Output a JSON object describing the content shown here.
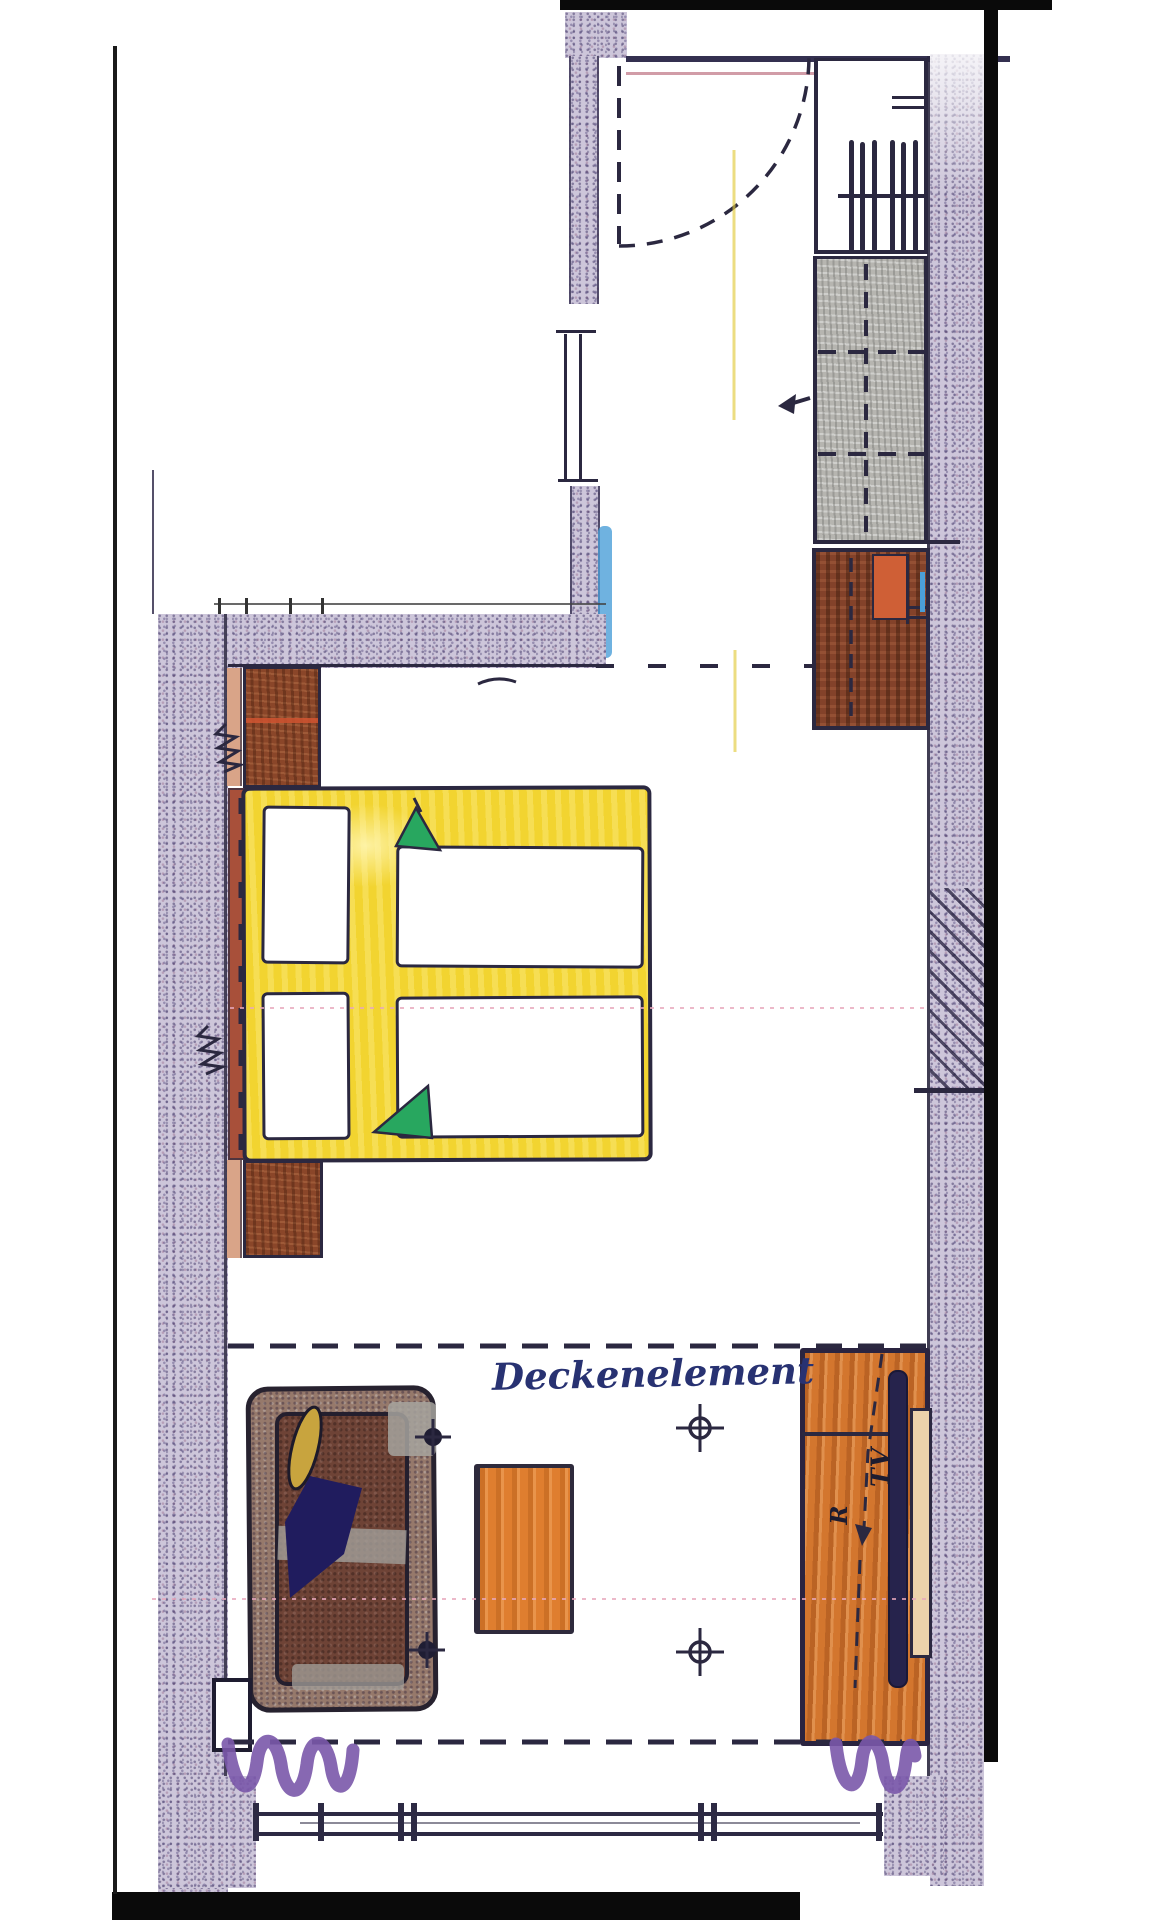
{
  "labels": {
    "ceiling_element": "Deckenelement",
    "tv": "TV",
    "shelf": "R"
  },
  "palette": {
    "ink": "#2b2840",
    "wall_base": "#cdc6da",
    "gray_base": "#b6b5b0",
    "bed_yellow": "#f2d430",
    "accent_green": "#28a75f",
    "headboard_red": "#a8503a",
    "nightstand_brown": "#8a4629",
    "cabinet_brown": "#83422a",
    "cabinet_orange": "#cf5f36",
    "sideboard_orange": "#d3762e",
    "table_orange": "#df7e2f",
    "sofa_maroon": "#6e4336",
    "throw_blue": "#201c5e",
    "pillow_yellow": "#c8a43e",
    "curtain_purple": "#7a58aa",
    "glass_blue": "#4b9fd8",
    "scan_black": "#0a0a0a",
    "fold_pink": "#e8a8bc",
    "salmon": "#d9a488"
  },
  "symbols": [
    "entry-door-swing",
    "wardrobe-with-hangers",
    "luggage-rack",
    "minibar-cabinet",
    "double-bed",
    "pillow",
    "duvet",
    "green-folded-corner",
    "nightstand",
    "headboard",
    "ceiling-element-dashed-line",
    "ceiling-light",
    "spotlight",
    "sofa",
    "coffee-table",
    "tv-sideboard",
    "flatscreen-tv",
    "curtain-squiggle",
    "window-front",
    "masonry-wall-hatch",
    "direction-arrow",
    "wall-socket-zigzag"
  ]
}
